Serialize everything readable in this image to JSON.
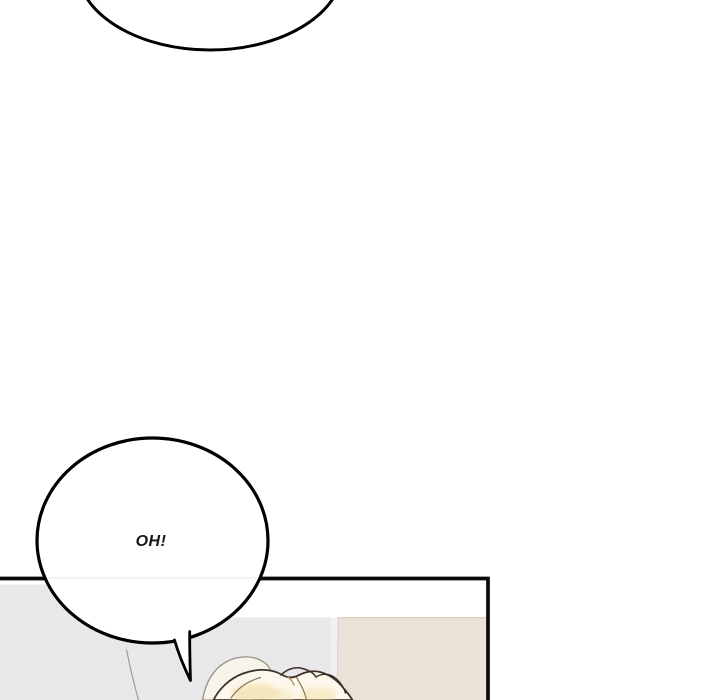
{
  "artwork": {
    "kind": "webtoon-comic-panel",
    "bubbles": {
      "top_partial": {
        "text": "",
        "note": "bottom arc of an off-screen speech bubble"
      },
      "oh": {
        "text": "OH!"
      }
    },
    "colors": {
      "page_background": "#ffffff",
      "outline": "#000000",
      "panel_border": "#0a0a0a",
      "bubble_fill": "#ffffff",
      "bubble_seam": "#efefef",
      "panel_interior": "#ffffff",
      "panel_wall_gray": "#e8e8eb",
      "panel_wall_gray_light": "#f1f1f4",
      "panel_wall_beige": "#ece1d6",
      "beige_top_edge": "#dccfc0",
      "beige_left_edge": "#d8d0c6",
      "hair_fill": "#fdf8ec",
      "hair_fill_back": "#f7f4ec",
      "hair_shade": "#f2dfa4",
      "hair_shade_light": "#f4e6b8",
      "hair_outline_dark": "#3c3126",
      "hair_outline_gray": "#9a9287",
      "hair_inner_brown": "#8d7b58",
      "hair_accent_tan": "#b98f52",
      "stray_strand": "#9e9e9e"
    }
  }
}
